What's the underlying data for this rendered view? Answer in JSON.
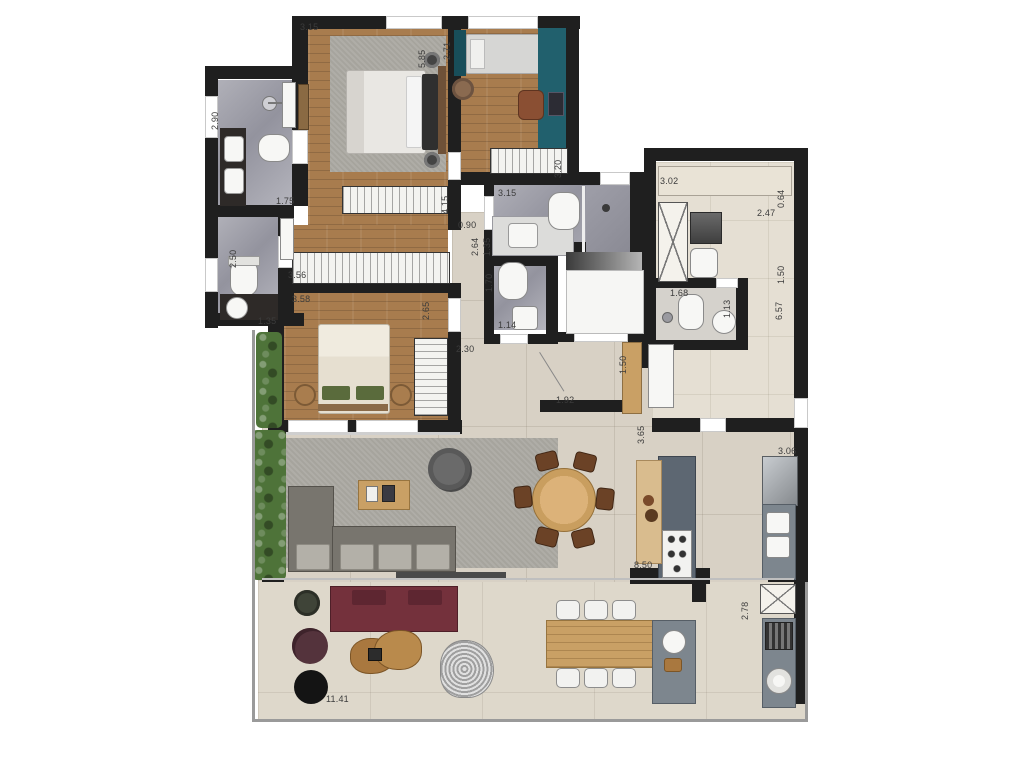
{
  "title": "apartment-floor-plan",
  "palette": {
    "wall": "#1f1f1f",
    "wood": "#a87c4e",
    "teal": "#21606d",
    "teal_dark": "#184e5a",
    "social": "#d8d1c5",
    "terrace": "#ded8cb",
    "service": "#e5dfd3",
    "bath": "#a2a2ac",
    "rug": "#a6a49d",
    "sofa": "#78756e",
    "seat": "#b3b0a8",
    "burgundy": "#74313c",
    "furniture_wood": "#c9a065",
    "island": "#5d6772",
    "counter": "#7d868e",
    "plant": "#4e7339",
    "label": "#3c3c3c"
  },
  "dimensions": [
    {
      "t": "3.15",
      "x": 300,
      "y": 22
    },
    {
      "t": "1.75",
      "x": 276,
      "y": 196
    },
    {
      "t": "1.35",
      "x": 258,
      "y": 316
    },
    {
      "t": "3.56",
      "x": 288,
      "y": 270
    },
    {
      "t": "3.58",
      "x": 292,
      "y": 294
    },
    {
      "t": "2.30",
      "x": 456,
      "y": 344
    },
    {
      "t": "0.90",
      "x": 458,
      "y": 220
    },
    {
      "t": "3.15",
      "x": 498,
      "y": 188
    },
    {
      "t": "1.14",
      "x": 498,
      "y": 320
    },
    {
      "t": "3.02",
      "x": 660,
      "y": 176
    },
    {
      "t": "2.47",
      "x": 757,
      "y": 208
    },
    {
      "t": "1.68",
      "x": 670,
      "y": 288
    },
    {
      "t": "1.92",
      "x": 556,
      "y": 395
    },
    {
      "t": "3.06",
      "x": 778,
      "y": 446
    },
    {
      "t": "8.50",
      "x": 634,
      "y": 560
    },
    {
      "t": "11.41",
      "x": 326,
      "y": 694
    },
    {
      "t": "5.85",
      "x": 427,
      "y": 58,
      "v": 1
    },
    {
      "t": "2.71",
      "x": 452,
      "y": 50,
      "v": 1
    },
    {
      "t": "2.90",
      "x": 220,
      "y": 120,
      "v": 1
    },
    {
      "t": "2.50",
      "x": 238,
      "y": 258,
      "v": 1
    },
    {
      "t": "2.65",
      "x": 431,
      "y": 310,
      "v": 1
    },
    {
      "t": "4.15",
      "x": 450,
      "y": 204,
      "v": 1
    },
    {
      "t": "2.64",
      "x": 480,
      "y": 246,
      "v": 1
    },
    {
      "t": "1.35",
      "x": 492,
      "y": 246,
      "v": 1
    },
    {
      "t": "1.70",
      "x": 494,
      "y": 282,
      "v": 1
    },
    {
      "t": "3.20",
      "x": 563,
      "y": 168,
      "v": 1
    },
    {
      "t": "0.64",
      "x": 786,
      "y": 198,
      "v": 1
    },
    {
      "t": "1.50",
      "x": 786,
      "y": 274,
      "v": 1
    },
    {
      "t": "6.57",
      "x": 784,
      "y": 310,
      "v": 1
    },
    {
      "t": "1.13",
      "x": 732,
      "y": 308,
      "v": 1
    },
    {
      "t": "1.50",
      "x": 628,
      "y": 364,
      "v": 1
    },
    {
      "t": "3.65",
      "x": 646,
      "y": 434,
      "v": 1
    },
    {
      "t": "2.78",
      "x": 750,
      "y": 610,
      "v": 1
    }
  ]
}
